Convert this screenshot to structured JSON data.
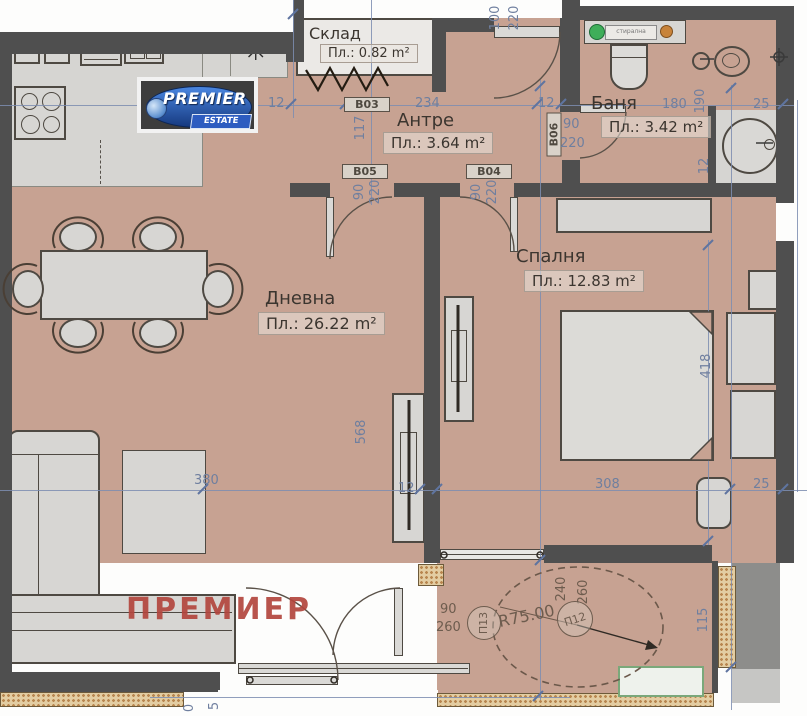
{
  "branding": {
    "logo_line1": "PREMIER",
    "logo_line2": "ESTATE",
    "watermark": "ПРЕМИЕР"
  },
  "rooms": {
    "sklad": {
      "name": "Склад",
      "area": "Пл.: 0.82 m²"
    },
    "antre": {
      "name": "Антре",
      "area": "Пл.: 3.64 m²"
    },
    "banya": {
      "name": "Баня",
      "area": "Пл.: 3.42 m²"
    },
    "spalnya": {
      "name": "Спалня",
      "area": "Пл.: 12.83 m²"
    },
    "dnevna": {
      "name": "Дневна",
      "area": "Пл.: 26.22 m²"
    }
  },
  "door_tags": {
    "b03": "В03",
    "b04": "В04",
    "b05": "В05",
    "b06": "В06"
  },
  "dims": {
    "n0": "0",
    "n5": "5",
    "n12": "12",
    "n25": "25",
    "n90": "90",
    "n100": "100",
    "n115": "115",
    "n117": "117",
    "n180": "180",
    "n190": "190",
    "n220": "220",
    "n234": "234",
    "n240": "240",
    "n260": "260",
    "n308": "308",
    "n380": "380",
    "n418": "418",
    "n568": "568",
    "r75": "R75.00"
  },
  "markers": {
    "p12": "П12",
    "p13": "П13"
  },
  "symbols": {
    "asterisk": "✳",
    "washer_label": "стирална"
  },
  "colors": {
    "floor": "#c7a292",
    "wall": "#4f4f4f",
    "dim_blue": "#6f7f9f",
    "dim_brown": "#6d5c4e",
    "watermark_red": "#b2453d",
    "logo_blue": "#2a5fc4",
    "washer_green": "#3fae5a",
    "washer_orange": "#c8833a",
    "hatch_tan": "#d9b97e",
    "furniture": "#d7d6d3",
    "terrace_box_green": "#7aa87a"
  }
}
